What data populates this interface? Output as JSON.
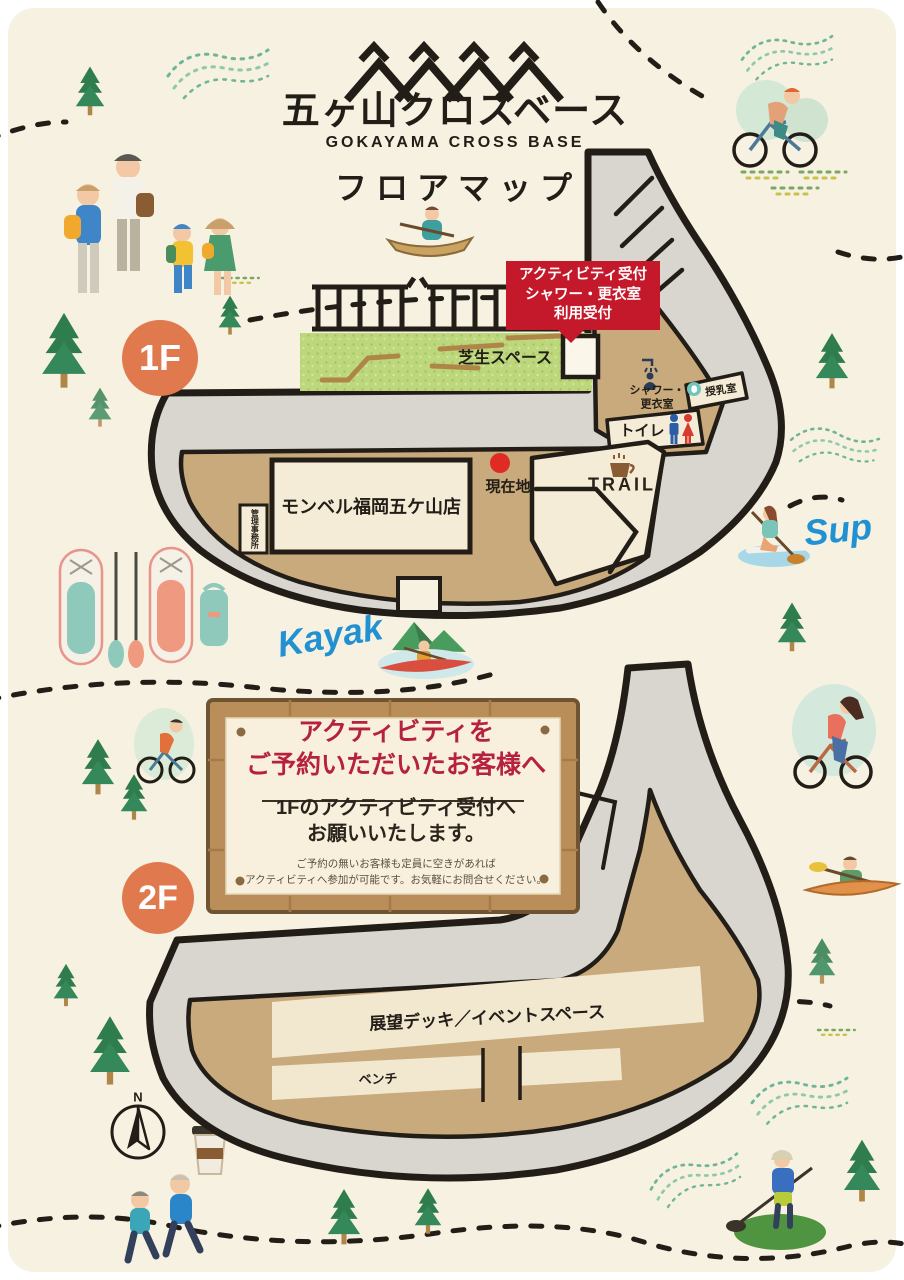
{
  "header": {
    "title_jp": "五ヶ山クロスベース",
    "title_en": "GOKAYAMA CROSS BASE",
    "subtitle": "フロアマップ"
  },
  "floor1": {
    "badge": "1F",
    "callout_lines": [
      "アクティビティ受付",
      "シャワー・更衣室",
      "利用受付"
    ],
    "lawn_label": "芝生スペース",
    "montbell_label": "モンベル福岡五ケ山店",
    "office_right_col": "管理",
    "office_left_col": "事務所",
    "current_location_label": "現在地",
    "trail_label": "TRAIL",
    "shower_label_line1": "シャワー・",
    "shower_label_line2": "更衣室",
    "nursing_label": "授乳室",
    "toilet_label": "トイレ"
  },
  "floor2": {
    "badge": "2F",
    "sign": {
      "heading_line1": "アクティビティを",
      "heading_line2": "ご予約いただいたお客様へ",
      "body_line1": "1Fのアクティビティ受付へ",
      "body_line2": "お願いいたします。",
      "note_line1": "ご予約の無いお客様も定員に空きがあれば",
      "note_line2": "アクティビティへ参加が可能です。お気軽にお問合せください。"
    },
    "deck_label": "展望デッキ／イベントスペース",
    "bench_label": "ベンチ"
  },
  "annotations": {
    "kayak": "Kayak",
    "sup": "Sup",
    "compass_north": "N"
  },
  "colors": {
    "background": "#f6f1e1",
    "walkway": "#d9d6d0",
    "deck": "#c9aa7c",
    "room": "#f4ecd6",
    "lawn": "#bcd77c",
    "outline": "#221d17",
    "callout_red": "#c4182b",
    "badge_orange": "#e0794d",
    "sign_heading_red": "#b5213f",
    "handwriting_blue": "#2191d2",
    "wood": "#b98e58"
  }
}
